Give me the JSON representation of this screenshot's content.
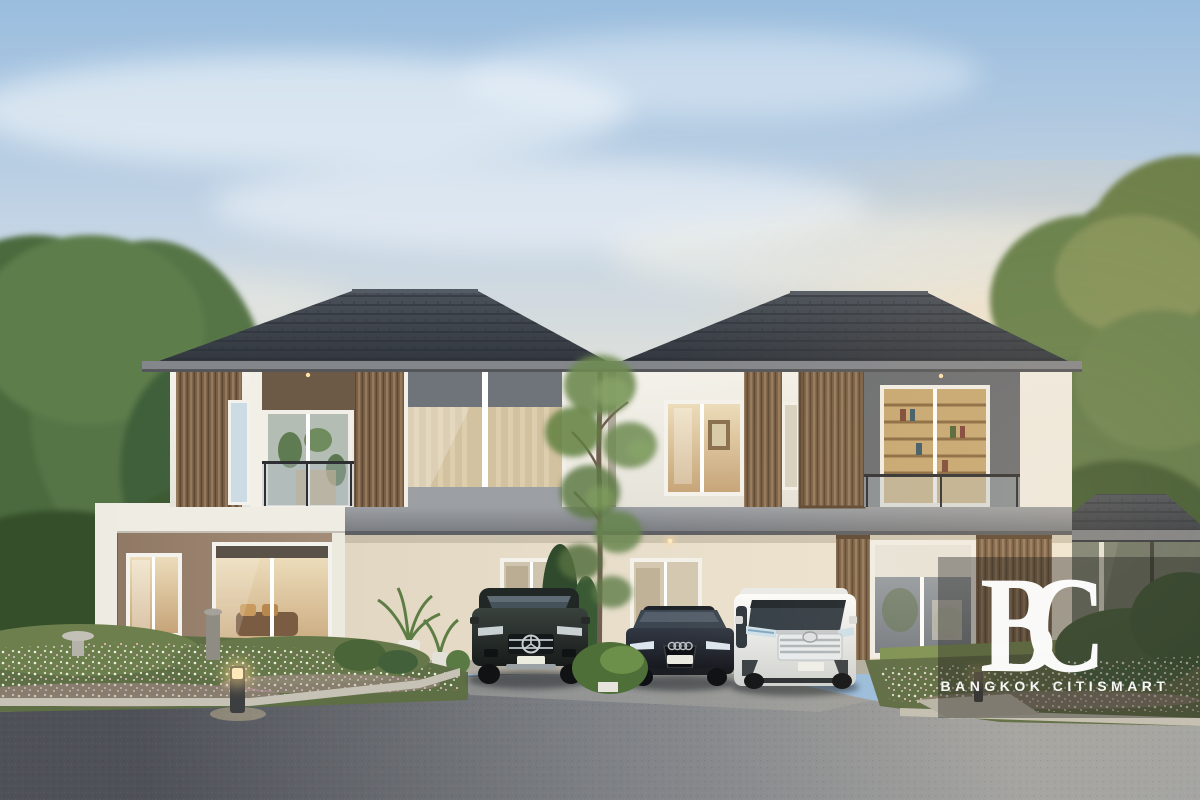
{
  "scene": {
    "description": "Dusk 3D rendering of twin modern two-storey houses with dark hip roofs, wood-slat facades, glass balconies, a shared carport with three parked cars (dark SUV, dark sedan, white minivan), flowering garden beds, bollard light and asphalt driveway, large trees on both sides",
    "objects": [
      "sky",
      "clouds",
      "trees-left",
      "trees-right",
      "house-left",
      "house-right",
      "right-pavilion",
      "left-wing",
      "carport",
      "garden-left",
      "garden-right",
      "front-tree",
      "road",
      "car-mercedes-suv",
      "car-audi-sedan",
      "car-toyota-vellfire",
      "bollard-light",
      "watermark"
    ]
  },
  "watermark": {
    "logo_text": "BC",
    "brand_name": "BANGKOK CITISMART",
    "text_color": "#ffffff",
    "overlay_color": "rgba(30,28,25,0.38)"
  },
  "palette": {
    "sky_top": "#9abdde",
    "sky_mid": "#c3d4e5",
    "sky_horizon": "#f0e2c9",
    "cloud": "#fbfdfe",
    "roof_dark": "#383d44",
    "fascia_gray": "#84878c",
    "slab_gray": "#8f9297",
    "wall_white": "#f2efe7",
    "wall_cream": "#e9dfcd",
    "wall_taupe": "#9b8572",
    "wood_slat": "#7c6248",
    "glass_gray": "#858d95",
    "interior_warm": "#d9c096",
    "tree_green": "#5d7b49",
    "flower_white": "#e8ecdc",
    "flower_pink": "#c98fa2",
    "road_light": "#a2a3a2",
    "road_dark": "#4e5157",
    "curb": "#c6c2b6",
    "car_suv": "#2c3230",
    "car_sedan": "#22262e",
    "car_van": "#f1f2f0",
    "warm_light": "#ffd9a0",
    "watermark_text": "#ffffff",
    "watermark_overlay": "rgba(30,28,25,0.38)"
  }
}
